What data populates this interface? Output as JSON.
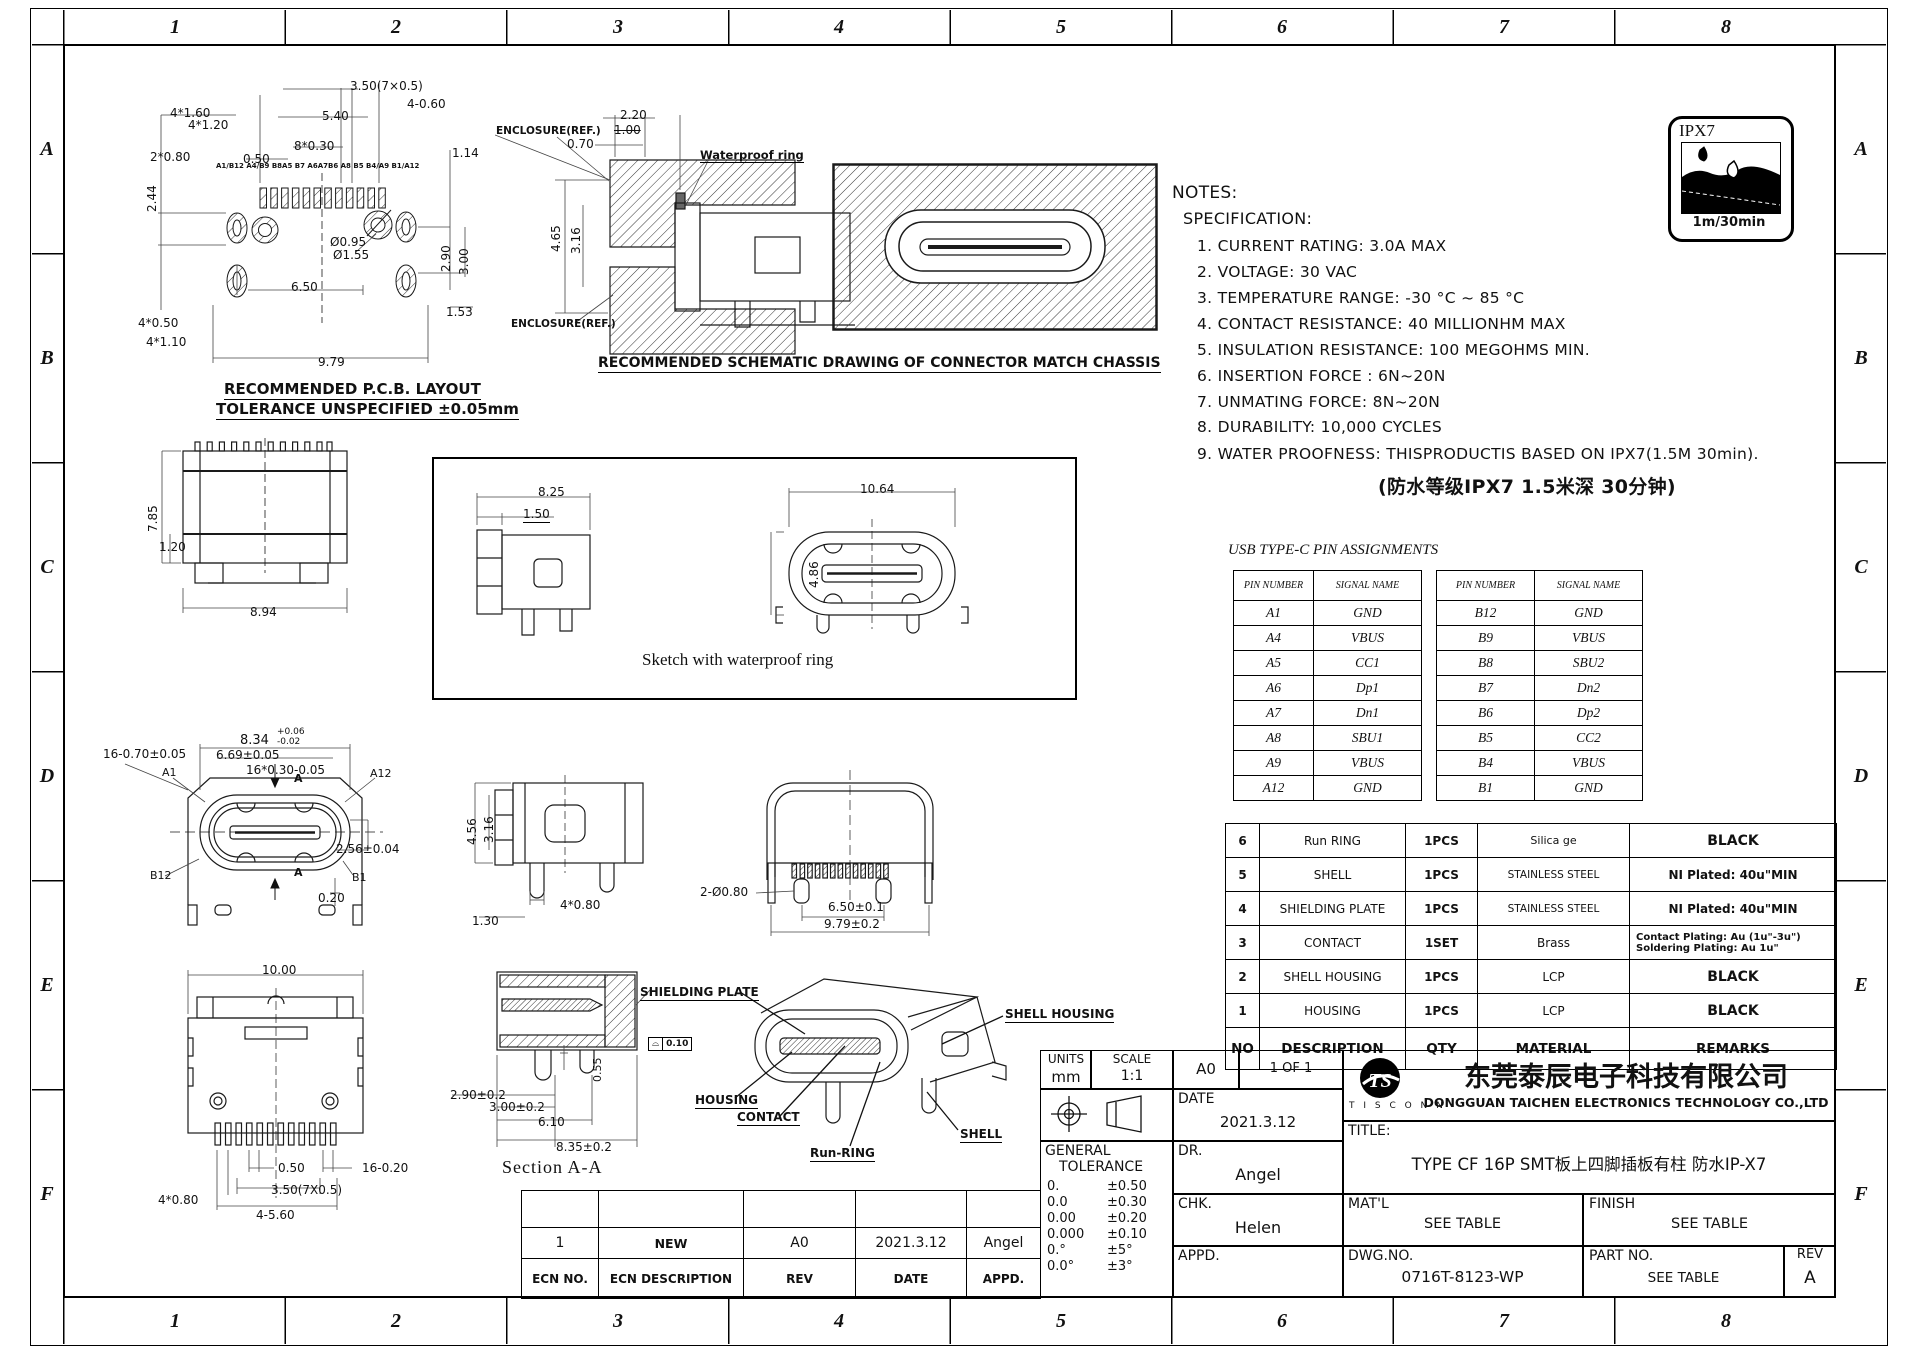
{
  "sheet": {
    "zh": [
      "1",
      "2",
      "3",
      "4",
      "5",
      "6",
      "7",
      "8"
    ],
    "zv": [
      "A",
      "B",
      "C",
      "D",
      "E",
      "F"
    ]
  },
  "badge": {
    "label": "IPX7",
    "caption": "1m/30min"
  },
  "notes": {
    "heading": "NOTES:",
    "subheading": "SPECIFICATION:",
    "items": [
      "1. CURRENT RATING: 3.0A MAX",
      "2. VOLTAGE: 30 VAC",
      "3. TEMPERATURE RANGE: -30 °C ~ 85 °C",
      "4. CONTACT RESISTANCE: 40 MILLIONHM MAX",
      "5. INSULATION RESISTANCE: 100 MEGOHMS MIN.",
      "6. INSERTION FORCE : 6N~20N",
      "7. UNMATING FORCE: 8N~20N",
      "8. DURABILITY:  10,000 CYCLES",
      "9. WATER PROOFNESS: THISPRODUCTIS BASED ON IPX7(1.5M 30min)."
    ],
    "cn": "(防水等级IPX7 1.5米深 30分钟)"
  },
  "pcb": {
    "cap1": "RECOMMENDED  P.C.B. LAYOUT",
    "cap2": "TOLERANCE UNSPECIFIED ±0.05mm",
    "d350": "3.50(7×0.5)",
    "d460": "4-0.60",
    "d540": "5.40",
    "d830": "8*0.30",
    "d050": "0.50",
    "d4160": "4*1.60",
    "d4120": "4*1.20",
    "d2080": "2*0.80",
    "pins": "A1/B12 A4/B9 B8A5 B7 A6A7B6 A8 B5 B4/A9 B1/A12",
    "d244": "2.44",
    "d095": "Ø0.95",
    "d155": "Ø1.55",
    "d650": "6.50",
    "d114": "1.14",
    "d290": "2.90",
    "d300": "3.00",
    "d153": "1.53",
    "d4050": "4*0.50",
    "d4110": "4*1.10",
    "d979": "9.79"
  },
  "chassis": {
    "enc1": "ENCLOSURE(REF.)",
    "enc2": "ENCLOSURE(REF.)",
    "ring": "Waterproof ring",
    "d220": "2.20",
    "d100": "1.00",
    "d070": "0.70",
    "d465": "4.65",
    "d316": "3.16",
    "cap": "RECOMMENDED SCHEMATIC DRAWING OF CONNECTOR MATCH CHASSIS"
  },
  "side1": {
    "d785": "7.85",
    "d120": "1.20",
    "d894": "8.94"
  },
  "sketch": {
    "cap": "Sketch with waterproof ring",
    "d825": "8.25",
    "d150": "1.50",
    "d1064": "10.64",
    "d486": "4.86"
  },
  "front": {
    "d834": "8.34",
    "tolp": "+0.06",
    "tolm": "-0.02",
    "d669": "6.69±0.05",
    "d1670": "16-0.70±0.05",
    "d1630": "16*0.30-0.05",
    "d256": "2.56±0.04",
    "d020": "0.20",
    "a1": "A1",
    "a12": "A12",
    "b12": "B12",
    "b1": "B1",
    "sec": "A"
  },
  "side2": {
    "d456": "4.56",
    "d316": "3.16",
    "d4080": "4*0.80",
    "d130": "1.30"
  },
  "rear": {
    "d2080": "2-Ø0.80",
    "d650": "6.50±0.1",
    "d979": "9.79±0.2"
  },
  "bottom": {
    "d1000": "10.00",
    "d050": "0.50",
    "d1620": "16-0.20",
    "d350": "3.50(7X0.5)",
    "d4080": "4*0.80",
    "d4560": "4-5.60"
  },
  "section": {
    "cap": "Section A-A",
    "d1": "2.90±0.2",
    "d2": "3.00±0.2",
    "d3": "6.10",
    "d4": "8.35±0.2",
    "d5": "0.55",
    "fsym": "⌓",
    "fval": "0.10"
  },
  "iso": {
    "l1": "SHIELDING PLATE",
    "l2": "SHELL HOUSING",
    "l3": "HOUSING",
    "l4": "CONTACT",
    "l5": "Run-RING",
    "l6": "SHELL"
  },
  "pins_table": {
    "title": "USB TYPE-C PIN ASSIGNMENTS",
    "h1": "PIN NUMBER",
    "h2": "SIGNAL NAME",
    "left": [
      [
        "A1",
        "GND"
      ],
      [
        "A4",
        "VBUS"
      ],
      [
        "A5",
        "CC1"
      ],
      [
        "A6",
        "Dp1"
      ],
      [
        "A7",
        "Dn1"
      ],
      [
        "A8",
        "SBU1"
      ],
      [
        "A9",
        "VBUS"
      ],
      [
        "A12",
        "GND"
      ]
    ],
    "right": [
      [
        "B12",
        "GND"
      ],
      [
        "B9",
        "VBUS"
      ],
      [
        "B8",
        "SBU2"
      ],
      [
        "B7",
        "Dn2"
      ],
      [
        "B6",
        "Dp2"
      ],
      [
        "B5",
        "CC2"
      ],
      [
        "B4",
        "VBUS"
      ],
      [
        "B1",
        "GND"
      ]
    ]
  },
  "bom": {
    "h": {
      "no": "NO",
      "desc": "DESCRIPTION",
      "qty": "QTY",
      "mat": "MATERIAL",
      "rem": "REMARKS"
    },
    "rows": [
      {
        "no": "6",
        "desc": "Run RING",
        "qty": "1PCS",
        "mat": "Silica ge",
        "rem": "BLACK"
      },
      {
        "no": "5",
        "desc": "SHELL",
        "qty": "1PCS",
        "mat": "STAINLESS STEEL",
        "rem": "NI  Plated: 40u\"MIN"
      },
      {
        "no": "4",
        "desc": "SHIELDING PLATE",
        "qty": "1PCS",
        "mat": "STAINLESS STEEL",
        "rem": "NI  Plated: 40u\"MIN"
      },
      {
        "no": "3",
        "desc": "CONTACT",
        "qty": "1SET",
        "mat": "Brass",
        "rem": "Contact Plating: Au (1u\"-3u\")",
        "rem2": "Soldering Plating: Au 1u\""
      },
      {
        "no": "2",
        "desc": "SHELL HOUSING",
        "qty": "1PCS",
        "mat": "LCP",
        "rem": "BLACK"
      },
      {
        "no": "1",
        "desc": "HOUSING",
        "qty": "1PCS",
        "mat": "LCP",
        "rem": "BLACK"
      }
    ]
  },
  "tb": {
    "units_l": "UNITS",
    "units_v": "mm",
    "scale_l": "SCALE",
    "scale_v": "1:1",
    "size": "A0",
    "sheet": "1 OF 1",
    "date_l": "DATE",
    "date_v": "2021.3.12",
    "dr_l": "DR.",
    "dr_v": "Angel",
    "chk_l": "CHK.",
    "chk_v": "Helen",
    "appd_l": "APPD.",
    "gen1": "GENERAL",
    "gen2": "TOLERANCE",
    "tol": [
      [
        "0.",
        "±0.50"
      ],
      [
        "0.0",
        "±0.30"
      ],
      [
        "0.00",
        "±0.20"
      ],
      [
        "0.000",
        "±0.10"
      ],
      [
        "0.°",
        "±5°"
      ],
      [
        "0.0°",
        "±3°"
      ]
    ],
    "logo": "TS",
    "logo_sub": "T I S C O N N",
    "cn": "东莞泰辰电子科技有限公司",
    "en": "DONGGUAN TAICHEN ELECTRONICS TECHNOLOGY CO.,LTD",
    "title_l": "TITLE:",
    "title_v": "TYPE CF 16P SMT板上四脚插板有柱 防水IP-X7",
    "matl_l": "MAT'L",
    "matl_v": "SEE TABLE",
    "fin_l": "FINISH",
    "fin_v": "SEE TABLE",
    "dwg_l": "DWG.NO.",
    "dwg_v": "0716T-8123-WP",
    "part_l": "PART NO.",
    "part_v": "SEE TABLE",
    "rev_l": "REV",
    "rev_v": "A"
  },
  "rev_table": {
    "r1": {
      "a": "1",
      "b": "NEW",
      "c": "A0",
      "d": "2021.3.12",
      "e": "Angel"
    },
    "h": {
      "a": "ECN NO.",
      "b": "ECN  DESCRIPTION",
      "c": "REV",
      "d": "DATE",
      "e": "APPD."
    }
  }
}
